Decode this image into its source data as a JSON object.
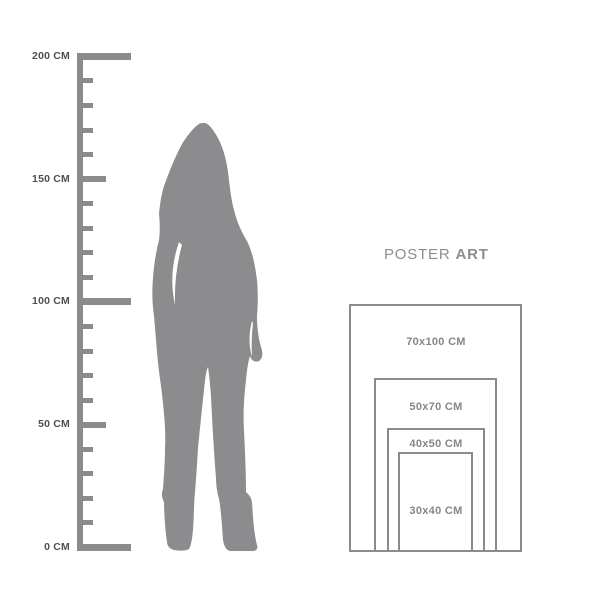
{
  "heading": {
    "regular": "POSTER",
    "bold": "ART"
  },
  "ruler": {
    "unit": "CM",
    "min_cm": 0,
    "max_cm": 200,
    "minor_step_cm": 10,
    "labels": [
      {
        "text": "200 CM",
        "cm": 200
      },
      {
        "text": "150 CM",
        "cm": 150
      },
      {
        "text": "100 CM",
        "cm": 100
      },
      {
        "text": "50 CM",
        "cm": 50
      },
      {
        "text": "0 CM",
        "cm": 0
      }
    ]
  },
  "silhouette": {
    "icon": "woman-silhouette"
  },
  "posters": [
    {
      "label": "70x100 CM"
    },
    {
      "label": "50x70 CM"
    },
    {
      "label": "40x50 CM"
    },
    {
      "label": "30x40 CM"
    }
  ],
  "colors": {
    "bg": "#ffffff",
    "ruler": "#8a8b8d",
    "ruler_label": "#4e4f52",
    "silhouette": "#8c8c8e",
    "poster_border": "#8a8b8d",
    "poster_label": "#85868a",
    "heading": "#8b8d90"
  }
}
